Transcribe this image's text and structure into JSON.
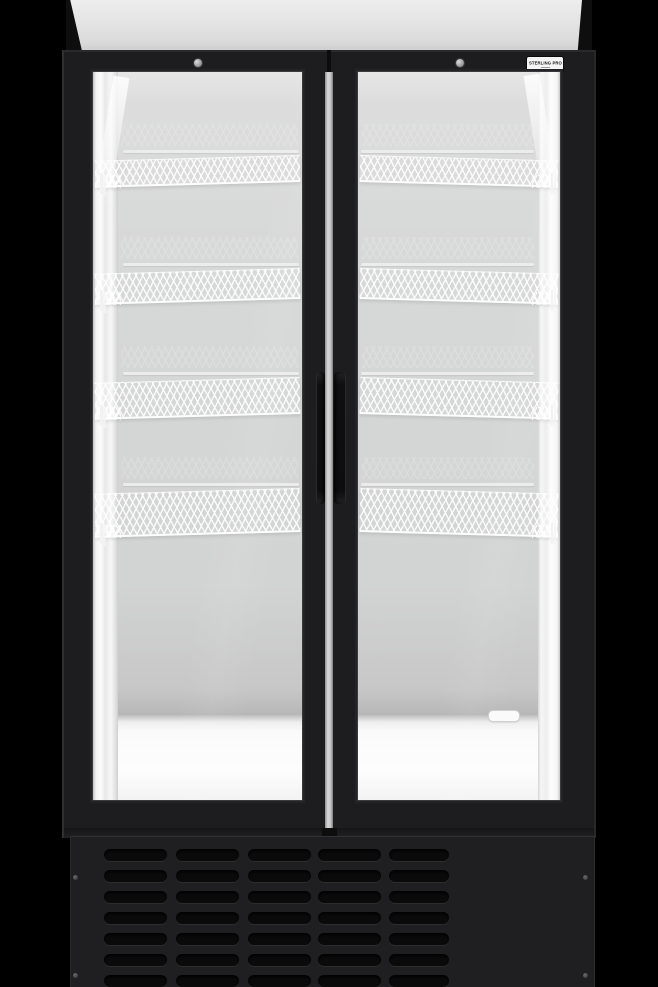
{
  "brand_badge": {
    "label": "STERLING PRO"
  },
  "fridge": {
    "doors": 2,
    "shelves_per_door": 4,
    "shelf_rail_y": [
      78,
      191,
      300,
      411
    ],
    "shelf_mesh_h": [
      24,
      28,
      34,
      41
    ],
    "grille": {
      "rows": 7,
      "columns": 5,
      "col_x": [
        34,
        106,
        178,
        248,
        319
      ],
      "col_w": [
        63,
        63,
        63,
        63,
        60
      ],
      "row_y": [
        13,
        34,
        55,
        76,
        97,
        118,
        139
      ],
      "slot_h": 12,
      "screw_xy": [
        [
          3,
          39
        ],
        [
          513,
          39
        ],
        [
          3,
          137
        ],
        [
          513,
          137
        ]
      ]
    },
    "colors": {
      "background": "#000000",
      "cabinet": "#1d1d1f",
      "canopy_panel": "#e4e4e4",
      "interior_wall": "#d5d6d6",
      "interior_floor": "#fcfcfc",
      "shelf_wire": "#ffffff",
      "mullion": "#c9c9c9",
      "grille_panel": "#1f1f21",
      "grille_slot": "#0a0a0b",
      "badge_bg": "#f5f5f5",
      "badge_text": "#141414"
    }
  }
}
